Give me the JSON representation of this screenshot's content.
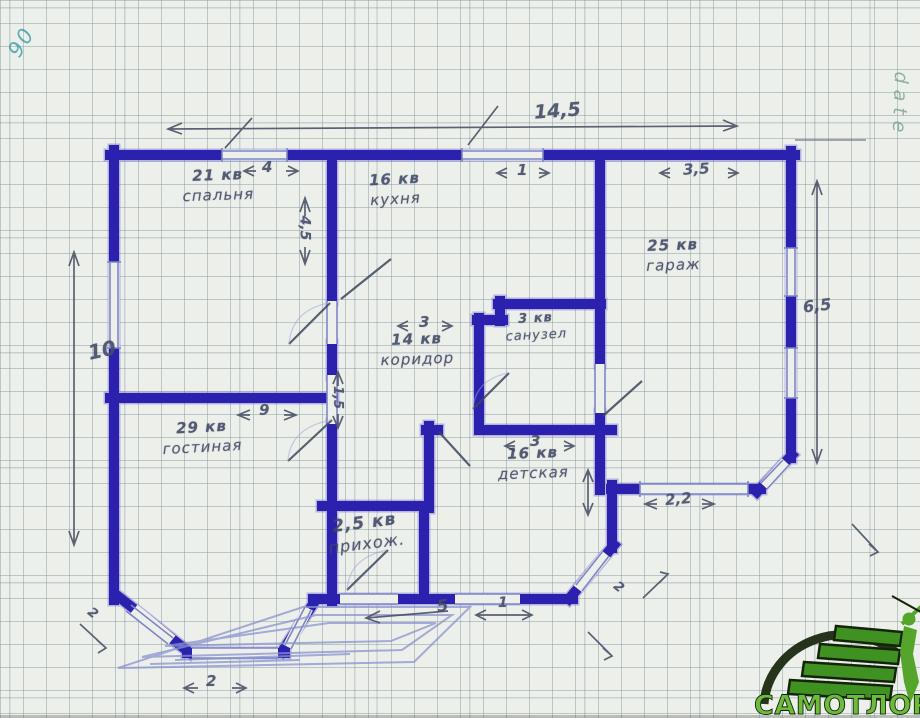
{
  "page": {
    "title": "Hand-drawn house floor plan on graph paper"
  },
  "notes": {
    "corner": "90",
    "side": "date"
  },
  "rooms": [
    {
      "area": "21 кв",
      "name": "спальня"
    },
    {
      "area": "16 кв",
      "name": "кухня"
    },
    {
      "area": "25 кв",
      "name": "гараж"
    },
    {
      "area": "14 кв",
      "name": "коридор"
    },
    {
      "area": "3 кв",
      "name": "санузел"
    },
    {
      "area": "29 кв",
      "name": "гостиная"
    },
    {
      "area": "16 кв",
      "name": "детская"
    },
    {
      "area": "2,5 кв",
      "name": "прихож."
    }
  ],
  "dimensions": {
    "total_width": "14,5",
    "left_height": "10",
    "right_height": "6,5",
    "bedroom_window": "4",
    "kitchen_top": "1",
    "garage_width": "3,5",
    "kitchen_depth": "4,5",
    "corridor_width": "3",
    "living_width": "9",
    "kids_width": "3",
    "corridor_door": "1,5",
    "garage_door": "2,2",
    "porch_width": "5",
    "porch_step": "1",
    "bay_window": "2",
    "bay_side": "2",
    "kids_bay": "2"
  },
  "logo": {
    "text": "САМОТЛОР"
  },
  "colors": {
    "ink": "#2b21ae",
    "pencil": "#4b5266",
    "paper": "#edf0ea",
    "teal_note": "#2f97a3",
    "green_note": "#7aa58a",
    "logo_green": "#6cbb3c",
    "logo_dark": "#142408"
  }
}
